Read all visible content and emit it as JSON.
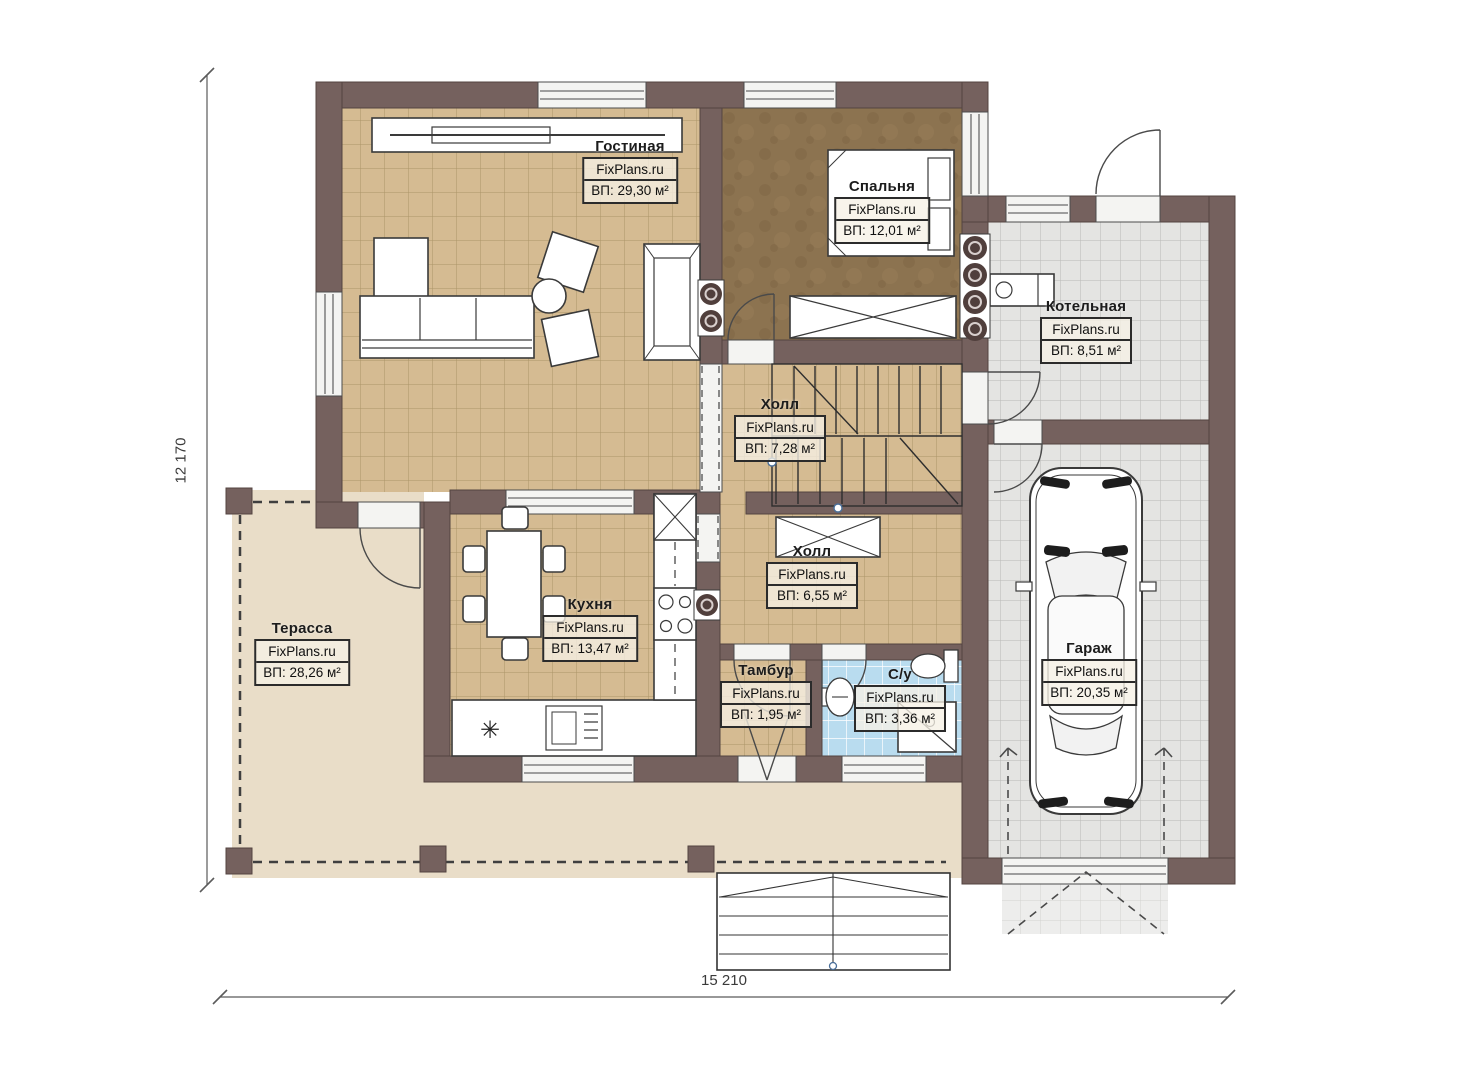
{
  "plan": {
    "watermark": "FixPlans.ru",
    "dimensions": {
      "width": "15 210",
      "height": "12 170"
    },
    "rooms": [
      {
        "key": "living",
        "name": "Гостиная",
        "area": "ВП: 29,30 м²"
      },
      {
        "key": "bedroom",
        "name": "Спальня",
        "area": "ВП: 12,01 м²"
      },
      {
        "key": "boiler",
        "name": "Котельная",
        "area": "ВП: 8,51 м²"
      },
      {
        "key": "hall_upper",
        "name": "Холл",
        "area": "ВП: 7,28 м²"
      },
      {
        "key": "hall_lower",
        "name": "Холл",
        "area": "ВП: 6,55 м²"
      },
      {
        "key": "kitchen",
        "name": "Кухня",
        "area": "ВП: 13,47 м²"
      },
      {
        "key": "terrace",
        "name": "Терасса",
        "area": "ВП: 28,26 м²"
      },
      {
        "key": "vestibule",
        "name": "Тамбур",
        "area": "ВП: 1,95 м²"
      },
      {
        "key": "bathroom",
        "name": "С/у",
        "area": "ВП: 3,36 м²"
      },
      {
        "key": "garage",
        "name": "Гараж",
        "area": "ВП: 20,35 м²"
      }
    ],
    "colors": {
      "wall": "#75615e",
      "wall_stroke": "#544440",
      "floor_tan": "#d5bb92",
      "floor_tan_grid": "#ab9468",
      "floor_bedroom": "#8c7350",
      "floor_gray": "#e4e4e2",
      "floor_gray_grid": "#b9b9b7",
      "floor_blue": "#b9dcef",
      "floor_blue_grid": "#ffffff",
      "floor_terrace": "#e9ddc8",
      "fixture": "#ffffff",
      "line": "#333333",
      "flue": "#503f3c"
    }
  }
}
